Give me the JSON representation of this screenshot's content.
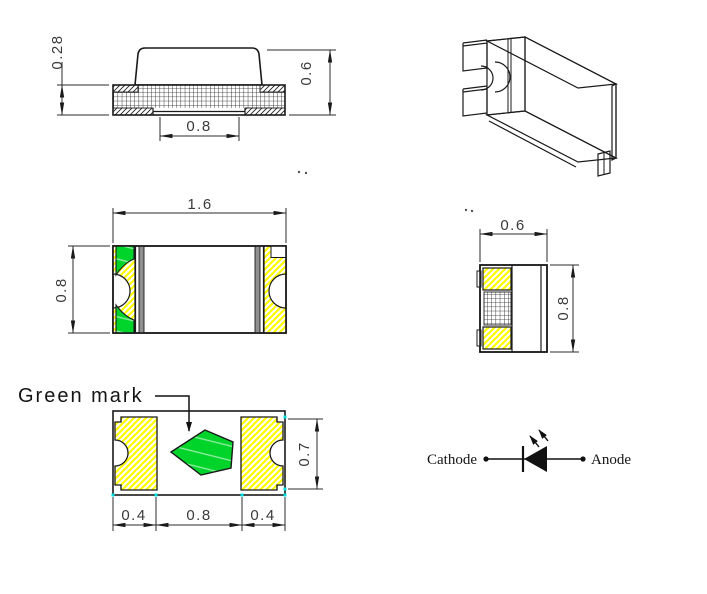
{
  "colors": {
    "green_mark": "#00D42A",
    "terminal_hatch_yellow": "#FFFF00",
    "separator_gray": "#8F8F8F",
    "corner_marker_cyan": "#00E0E0",
    "line": "#1A1A1A",
    "dim_text": "#3A3A3A"
  },
  "side_view": {
    "dim_base_height": "0.28",
    "dim_total_height": "0.6",
    "dim_bottom_pads_gap": "0.8"
  },
  "top_view": {
    "dim_length": "1.6",
    "dim_width": "0.8"
  },
  "end_view": {
    "dim_width": "0.6",
    "dim_height": "0.8"
  },
  "bottom_view": {
    "green_mark_label": "Green mark",
    "dim_left_pad": "0.4",
    "dim_center_gap": "0.8",
    "dim_right_pad": "0.4",
    "dim_pad_height": "0.7"
  },
  "polarity_symbol": {
    "cathode_label": "Cathode",
    "anode_label": "Anode"
  }
}
